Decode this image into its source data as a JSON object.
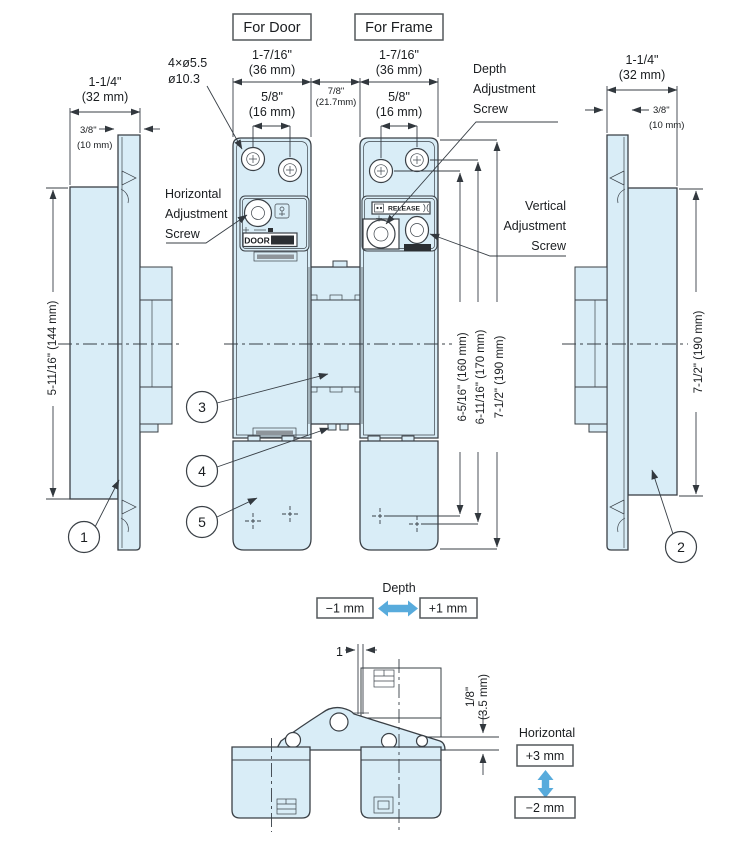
{
  "colors": {
    "part_fill": "#d9edf7",
    "line": "#3a4046",
    "accent_arrow": "#58abdc",
    "text": "#1a1d20",
    "box_border": "#54585c"
  },
  "headers": {
    "for_door": "For Door",
    "for_frame": "For Frame"
  },
  "callouts": {
    "c1": "1",
    "c2": "2",
    "c3": "3",
    "c4": "4",
    "c5": "5"
  },
  "labels": {
    "holes_line1": "4×ø5.5",
    "holes_line2": "ø10.3",
    "horizontal_adjustment": [
      "Horizontal",
      "Adjustment",
      "Screw"
    ],
    "depth_adjustment": [
      "Depth",
      "Adjustment",
      "Screw"
    ],
    "vertical_adjustment": [
      "Vertical",
      "Adjustment",
      "Screw"
    ],
    "door_marking": "DOOR",
    "release_marking": "RELEASE"
  },
  "dimensions": {
    "left_view": {
      "width": "1-1/4\"",
      "width_mm": "(32 mm)",
      "lip": "3/8\"",
      "lip_mm": "(10 mm)",
      "height": "5-11/16\"  (144 mm)"
    },
    "right_view": {
      "width": "1-1/4\"",
      "width_mm": "(32 mm)",
      "lip": "3/8\"",
      "lip_mm": "(10 mm)",
      "height": "7-1/2\"  (190 mm)"
    },
    "front_view": {
      "door_width": "1-7/16\"",
      "door_width_mm": "(36 mm)",
      "frame_width": "1-7/16\"",
      "frame_width_mm": "(36 mm)",
      "gap": "7/8\"",
      "gap_mm": "(21.7mm)",
      "door_screw_span": "5/8\"",
      "door_screw_span_mm": "(16 mm)",
      "frame_screw_span": "5/8\"",
      "frame_screw_span_mm": "(16 mm)",
      "height_160": "6-5/16\"  (160 mm)",
      "height_170": "6-11/16\"  (170 mm)",
      "height_190": "7-1/2\"  (190 mm)"
    },
    "top_view": {
      "offset_1": "1",
      "reveal": "1/8\"",
      "reveal_mm": "(3.5 mm)"
    }
  },
  "adjustments": {
    "depth": {
      "title": "Depth",
      "minus": "−1 mm",
      "plus": "+1 mm"
    },
    "horizontal": {
      "title": "Horizontal",
      "plus": "+3 mm",
      "minus": "−2 mm"
    }
  }
}
